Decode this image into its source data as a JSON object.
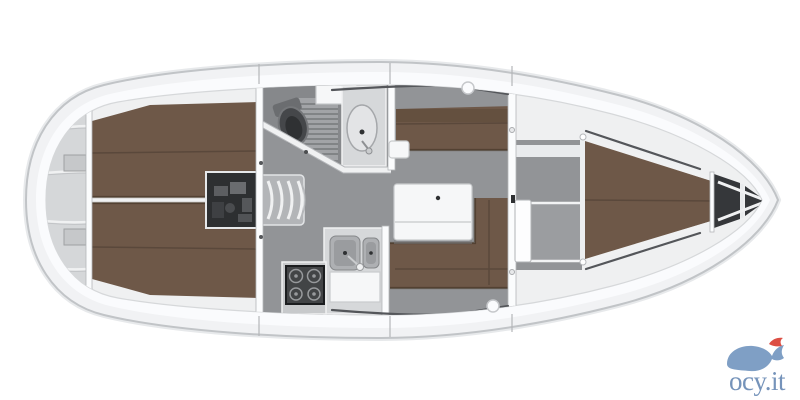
{
  "figure": {
    "kind": "sailing-yacht-interior-floor-plan",
    "orientation": "bow-right",
    "regions": [
      "stern-platform",
      "aft-cabin-port",
      "aft-cabin-starboard",
      "engine-compartment",
      "companionway-steps",
      "head-bathroom",
      "galley",
      "salon",
      "forward-cabin",
      "v-berth",
      "anchor-locker"
    ]
  },
  "logo": {
    "text": "ocy.it",
    "icon": "whale-with-fish-icon"
  },
  "palette": {
    "hull_line": "#c1c4c7",
    "deck": "#f1f2f4",
    "deck_light": "#fafbfd",
    "interior": "#eff0f1",
    "floor": "#929497",
    "floor_dark": "#86888b",
    "berth": "#6e5848",
    "berth_dark": "#64503f",
    "berth_seam": "#57453a",
    "berth_edge": "#453526",
    "wall": "#fbfcfd",
    "wall_edge": "#b4b6b9",
    "stern": "#d5d7d9",
    "engine": "#2d2f31",
    "anchor": "#35373a",
    "white_furniture": "#f6f7f8",
    "counter": "#d6d8da",
    "sink": "#aeb0b3",
    "sink_inner": "#9a9c9f",
    "stove": "#424446",
    "steps": "#b3b5b8",
    "detail_dark": "#2e3032",
    "trim_white": "#f0f1f2",
    "window": "#54565a",
    "logo_body": "#7f9fc5",
    "logo_text": "#7593ba",
    "logo_red": "#dc4f44"
  }
}
